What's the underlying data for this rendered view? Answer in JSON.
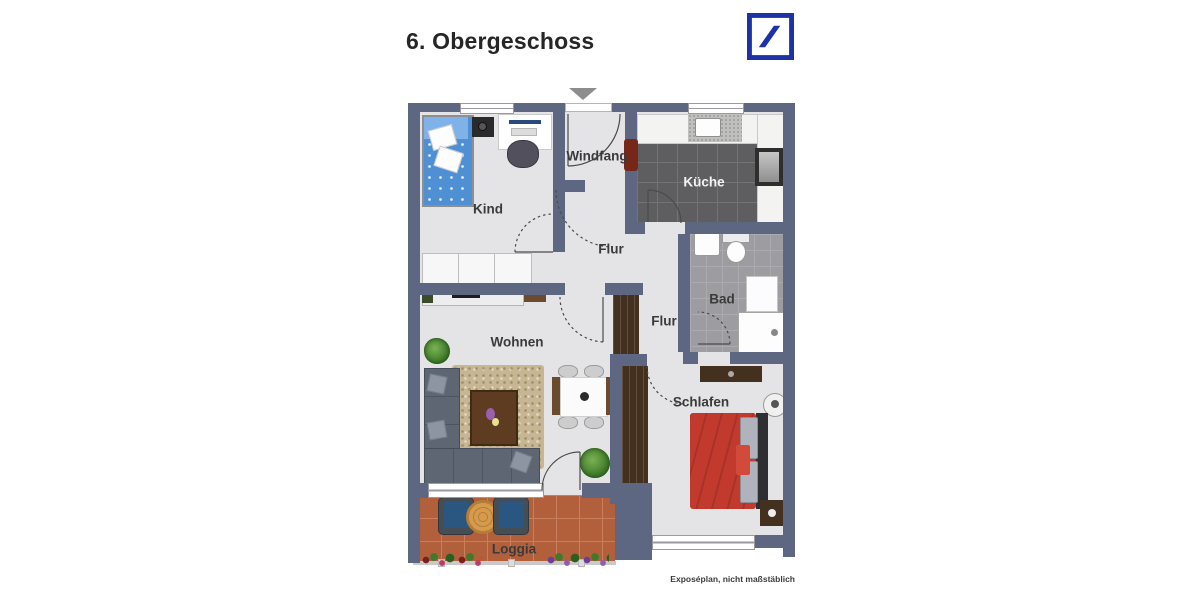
{
  "page": {
    "title": "6. Obergeschoss",
    "caption": "Exposéplan, nicht maßstäblich",
    "watermark": "Illustration©ImmoGrafik"
  },
  "logo": {
    "color": "#1d32a5"
  },
  "plan": {
    "rooms": [
      {
        "label": "Kind"
      },
      {
        "label": "Windfang"
      },
      {
        "label": "Küche"
      },
      {
        "label": "Flur"
      },
      {
        "label": "Bad"
      },
      {
        "label": "Flur"
      },
      {
        "label": "Wohnen"
      },
      {
        "label": "Schlafen"
      },
      {
        "label": "Loggia"
      }
    ],
    "colors": {
      "wall": "#5d6782",
      "floor": "#e4e4e6",
      "kitchen-floor": "#5e5e60",
      "bath-floor": "#9d9da1",
      "loggia-floor": "#b2603c",
      "rug": "#c7b693",
      "wood-dark": "#44301f",
      "wood-mid": "#6b4a2e",
      "sofa": "#5f6673",
      "bed-red": "#c23a2e",
      "kid-bed-blue": "#4f8fd4",
      "brand-blue": "#1d32a5",
      "line": "#4b4b4b"
    }
  }
}
